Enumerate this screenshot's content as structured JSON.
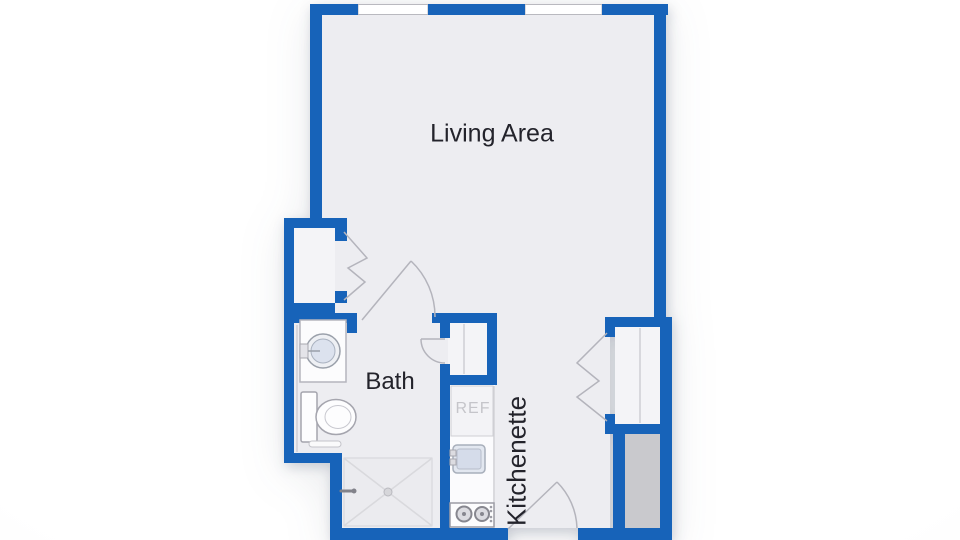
{
  "floorplan": {
    "rooms": [
      {
        "id": "living-area",
        "label": "Living Area"
      },
      {
        "id": "bath",
        "label": "Bath"
      },
      {
        "id": "kitchenette",
        "label": "Kitchenette"
      }
    ],
    "appliances": [
      {
        "id": "refrigerator",
        "label": "REF"
      }
    ],
    "fixtures": [
      "bathroom-sink",
      "toilet",
      "shower",
      "kitchen-sink",
      "stove",
      "closet-left",
      "closet-right",
      "linen-closet",
      "utility-chase"
    ],
    "doors": [
      "bath-door-swing",
      "entry-door-swing",
      "linen-closet-door",
      "bifold-closet-door-left",
      "bifold-closet-door-right"
    ],
    "windows_count": 2,
    "colors": {
      "wall": "#1763b9",
      "floor": "#ededf1",
      "closetFloor": "#f4f4f7",
      "counterFill": "#fbfbfd",
      "utilityFill": "#c9c9cd",
      "windowFill": "#ffffff",
      "windowStroke": "#b9b9bf",
      "doorStroke": "#b4b4bc",
      "dividerStroke": "#cfcfd4",
      "fixtureStroke": "#a5a5ae",
      "labelText": "#23232b",
      "refText": "#c5c5ca"
    }
  }
}
